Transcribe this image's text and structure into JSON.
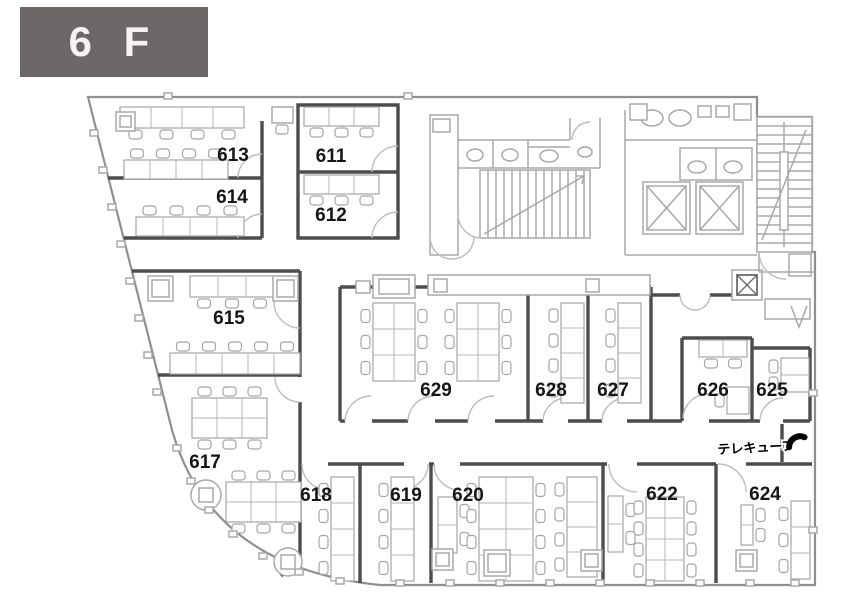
{
  "header": {
    "floor_label": "6 F"
  },
  "floor_plan": {
    "title": "Office floor plan, 6th floor",
    "rooms": [
      {
        "label": "611"
      },
      {
        "label": "612"
      },
      {
        "label": "613"
      },
      {
        "label": "614"
      },
      {
        "label": "615"
      },
      {
        "label": "617"
      },
      {
        "label": "618"
      },
      {
        "label": "619"
      },
      {
        "label": "620"
      },
      {
        "label": "622"
      },
      {
        "label": "624"
      },
      {
        "label": "625"
      },
      {
        "label": "626"
      },
      {
        "label": "627"
      },
      {
        "label": "628"
      },
      {
        "label": "629"
      }
    ],
    "facilities": [
      "stairs-top-center",
      "stairs-top-right",
      "elevator-1",
      "elevator-2",
      "toilet-stalls",
      "washroom",
      "phone-booth"
    ]
  },
  "annotations": {
    "telecube": {
      "label": "テレキューブ",
      "icon": "phone-icon"
    }
  },
  "colors": {
    "badge_bg": "#6b6867",
    "badge_text": "#f5f4f3",
    "wall_dark": "#4d4d4d",
    "wall_light": "#a8a8a8",
    "label_text": "#161616",
    "phone_icon": "#000000"
  }
}
